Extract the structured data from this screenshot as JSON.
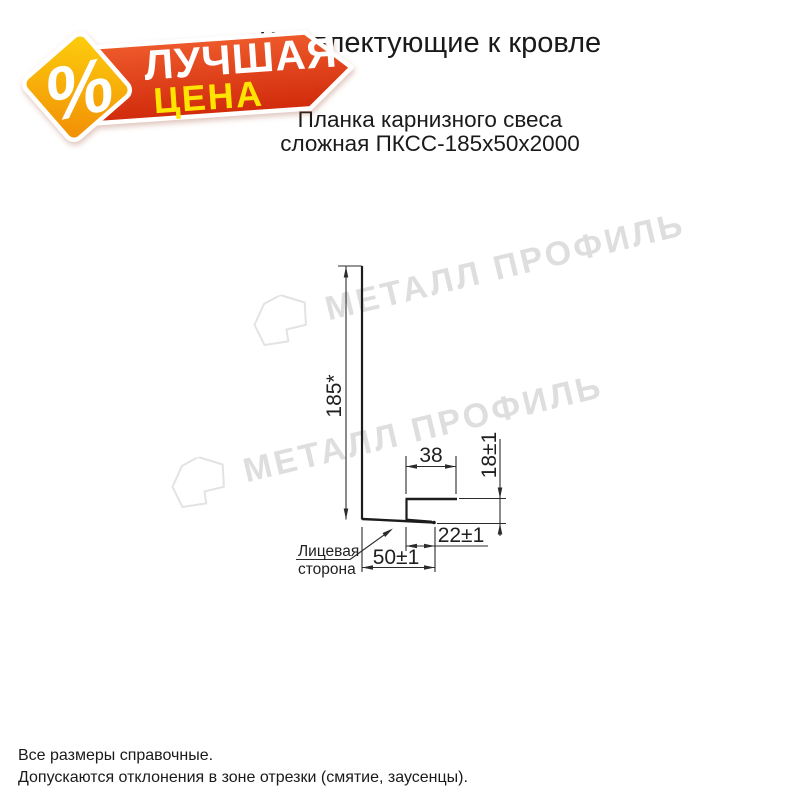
{
  "header": {
    "title": "Комплектующие к кровле",
    "subtitle_line1": "Планка карнизного свеса",
    "subtitle_line2": "сложная ПКСС-185х50х2000"
  },
  "badge": {
    "percent": "%",
    "word1": "ЛУЧШАЯ",
    "word2": "ЦЕНА",
    "banner_color": "#d63212",
    "diamond_color": "#f6a309",
    "word1_color": "#ffffff",
    "word2_color": "#ffe400"
  },
  "watermark": {
    "text": "МЕТАЛЛ ПРОФИЛЬ"
  },
  "drawing": {
    "dim_height": "185*",
    "dim_top_flange": "38",
    "dim_right_height": "18±1",
    "dim_bottom_lip": "22±1",
    "dim_bottom_width": "50±1",
    "leader_line1": "Лицевая",
    "leader_line2": "сторона"
  },
  "footer": {
    "line1": "Все размеры справочные.",
    "line2": "Допускаются отклонения в зоне отрезки (смятие, заусенцы)."
  }
}
